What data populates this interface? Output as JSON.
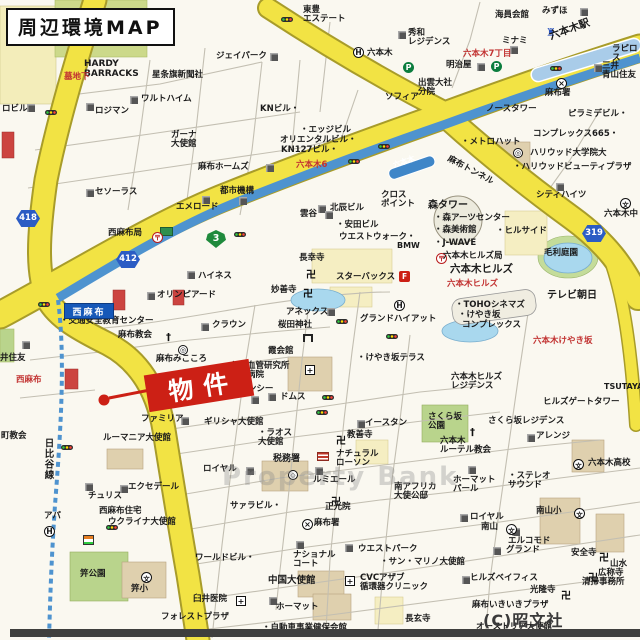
{
  "title": "周辺環境MAP",
  "copyright": "(C)昭文社",
  "watermark": "Property Bank",
  "property_marker": {
    "label": "物件"
  },
  "signs": {
    "nishiazabu": "西麻布"
  },
  "colors": {
    "road_yellow": "#f2e344",
    "subway_blue": "#4e93cf",
    "park_green": "#b9d48c",
    "pond_blue": "#a9d8ee",
    "marker_red": "#cc2015",
    "sign_blue": "#1658b8",
    "shield_blue": "#2b5cc4",
    "shield_green": "#1f8a3c"
  },
  "road_shields": [
    {
      "kind": "metro",
      "num": "3",
      "x": 206,
      "y": 230
    },
    {
      "kind": "pref",
      "num": "412",
      "x": 116,
      "y": 251
    },
    {
      "kind": "pref",
      "num": "418",
      "x": 16,
      "y": 210
    },
    {
      "kind": "pref",
      "num": "319",
      "x": 582,
      "y": 225
    }
  ],
  "labels": [
    {
      "t": "HARDY\nBARRACKS",
      "x": 84,
      "y": 60,
      "fs": 9
    },
    {
      "t": "星条旗新聞社",
      "x": 152,
      "y": 71
    },
    {
      "t": "墓地下",
      "x": 64,
      "y": 73,
      "c": "#c23332"
    },
    {
      "t": "ジェイパーク",
      "x": 216,
      "y": 52
    },
    {
      "t": "東豊\nエステート",
      "x": 303,
      "y": 6
    },
    {
      "t": "秀和\nレジデンス",
      "x": 408,
      "y": 29
    },
    {
      "t": "みずほ",
      "x": 542,
      "y": 7
    },
    {
      "t": "海員会館",
      "x": 495,
      "y": 11
    },
    {
      "t": "ミナミ",
      "x": 502,
      "y": 37
    },
    {
      "t": "明治屋",
      "x": 446,
      "y": 61
    },
    {
      "t": "六本木",
      "x": 367,
      "y": 49
    },
    {
      "t": "出雲大社\n分院",
      "x": 418,
      "y": 79
    },
    {
      "t": "ソフィア",
      "x": 385,
      "y": 93
    },
    {
      "t": "三井\n青山住友",
      "x": 602,
      "y": 62
    },
    {
      "t": "麻布署",
      "x": 545,
      "y": 89
    },
    {
      "t": "ラピロス",
      "x": 612,
      "y": 45
    },
    {
      "t": "六本木7丁目",
      "x": 463,
      "y": 50,
      "c": "#c23332"
    },
    {
      "t": "六本木駅",
      "x": 548,
      "y": 32,
      "fs": 10.5,
      "r": -20,
      "b": 1
    },
    {
      "t": "六本木",
      "x": 392,
      "y": 162,
      "c": "#fff",
      "fs": 7.5,
      "r": -19
    },
    {
      "t": "ワルトハイム",
      "x": 141,
      "y": 95
    },
    {
      "t": "ロジマン",
      "x": 95,
      "y": 107
    },
    {
      "t": "ロビル",
      "x": 2,
      "y": 105
    },
    {
      "t": "KNビル・",
      "x": 260,
      "y": 105
    },
    {
      "t": "ガーナ\n大使館",
      "x": 171,
      "y": 131
    },
    {
      "t": "・エッジビル",
      "x": 300,
      "y": 126
    },
    {
      "t": "オリエンタルビル・",
      "x": 280,
      "y": 136
    },
    {
      "t": "KN127ビル・",
      "x": 281,
      "y": 146
    },
    {
      "t": "六本木6",
      "x": 296,
      "y": 161,
      "c": "#c23332"
    },
    {
      "t": "麻布ホームズ",
      "x": 198,
      "y": 163
    },
    {
      "t": "都市機構",
      "x": 220,
      "y": 187
    },
    {
      "t": "セソーラス",
      "x": 95,
      "y": 188
    },
    {
      "t": "エメロード",
      "x": 176,
      "y": 203
    },
    {
      "t": "ハイネス",
      "x": 198,
      "y": 272
    },
    {
      "t": "西麻布局",
      "x": 108,
      "y": 229
    },
    {
      "t": "オリンピアード",
      "x": 157,
      "y": 291
    },
    {
      "t": "麻布トンネル",
      "x": 450,
      "y": 155,
      "r": 28
    },
    {
      "t": "・メトロハット",
      "x": 461,
      "y": 138
    },
    {
      "t": "ノースタワー",
      "x": 486,
      "y": 105
    },
    {
      "t": "ピラミデビル・",
      "x": 568,
      "y": 110
    },
    {
      "t": "コンプレックス665・",
      "x": 533,
      "y": 130
    },
    {
      "t": "ハリウッド大学院大",
      "x": 530,
      "y": 149
    },
    {
      "t": "・ハリウッドビューティプラザ",
      "x": 513,
      "y": 163
    },
    {
      "t": "シティハイツ",
      "x": 536,
      "y": 191
    },
    {
      "t": "クロス\nポイント",
      "x": 381,
      "y": 191
    },
    {
      "t": "北辰ビル",
      "x": 330,
      "y": 204
    },
    {
      "t": "雲谷",
      "x": 300,
      "y": 210
    },
    {
      "t": "・安田ビル",
      "x": 336,
      "y": 221
    },
    {
      "t": "ウエストウォーク・",
      "x": 339,
      "y": 233
    },
    {
      "t": "BMW",
      "x": 397,
      "y": 242,
      "fs": 8,
      "b": 1
    },
    {
      "t": "長幸寺",
      "x": 299,
      "y": 254
    },
    {
      "t": "妙善寺",
      "x": 271,
      "y": 286
    },
    {
      "t": "スターバックス",
      "x": 336,
      "y": 273
    },
    {
      "t": "森タワー",
      "x": 428,
      "y": 200,
      "fs": 10
    },
    {
      "t": "・森アーツセンター",
      "x": 434,
      "y": 214
    },
    {
      "t": "・森美術館",
      "x": 434,
      "y": 226
    },
    {
      "t": "・ヒルサイド",
      "x": 496,
      "y": 227
    },
    {
      "t": "・J-WAVE",
      "x": 434,
      "y": 239
    },
    {
      "t": "六本木ヒルズ局",
      "x": 443,
      "y": 252
    },
    {
      "t": "六本木ヒルズ",
      "x": 450,
      "y": 264,
      "fs": 10.5
    },
    {
      "t": "六本木ヒルズ",
      "x": 447,
      "y": 280,
      "c": "#c23332"
    },
    {
      "t": "・TOHOシネマズ",
      "x": 455,
      "y": 301
    },
    {
      "t": "・けやき坂",
      "x": 458,
      "y": 311
    },
    {
      "t": "コンプレックス",
      "x": 462,
      "y": 321
    },
    {
      "t": "毛利庭園",
      "x": 544,
      "y": 249
    },
    {
      "t": "テレビ朝日",
      "x": 547,
      "y": 290,
      "fs": 10
    },
    {
      "t": "六本木けやき坂",
      "x": 533,
      "y": 337,
      "c": "#c23332"
    },
    {
      "t": "六本木ヒルズ\nレジデンス",
      "x": 451,
      "y": 373
    },
    {
      "t": "・けやき坂テラス",
      "x": 357,
      "y": 354
    },
    {
      "t": "グランドハイアット",
      "x": 360,
      "y": 315
    },
    {
      "t": "桜田神社",
      "x": 278,
      "y": 321
    },
    {
      "t": "霞会館",
      "x": 268,
      "y": 347
    },
    {
      "t": "心臓血管研究所\n付属病院",
      "x": 230,
      "y": 362
    },
    {
      "t": "ドムス",
      "x": 280,
      "y": 393
    },
    {
      "t": "アネックス",
      "x": 286,
      "y": 308
    },
    {
      "t": "リージェンシー",
      "x": 214,
      "y": 385
    },
    {
      "t": "・交通安全教育センター",
      "x": 60,
      "y": 317
    },
    {
      "t": "麻布教会",
      "x": 118,
      "y": 331
    },
    {
      "t": "クラウン",
      "x": 212,
      "y": 321
    },
    {
      "t": "麻布みこころ",
      "x": 156,
      "y": 355
    },
    {
      "t": "ギリシャ大使館",
      "x": 204,
      "y": 418
    },
    {
      "t": "・ラオス\n大使館",
      "x": 258,
      "y": 429
    },
    {
      "t": "教善寺",
      "x": 347,
      "y": 431
    },
    {
      "t": "ファミリア",
      "x": 141,
      "y": 415
    },
    {
      "t": "ルーマニア大使館",
      "x": 103,
      "y": 434
    },
    {
      "t": "エクセデール",
      "x": 128,
      "y": 483
    },
    {
      "t": "チュリス",
      "x": 88,
      "y": 492
    },
    {
      "t": "西麻布住宅",
      "x": 99,
      "y": 507
    },
    {
      "t": "ウクライナ大使館",
      "x": 108,
      "y": 518
    },
    {
      "t": "アパ",
      "x": 44,
      "y": 512
    },
    {
      "t": "町教会",
      "x": 1,
      "y": 432
    },
    {
      "t": "日比谷線",
      "x": 42,
      "y": 438,
      "v": 1,
      "fs": 9.5,
      "b": 1
    },
    {
      "t": "税務署",
      "x": 273,
      "y": 455,
      "fs": 9
    },
    {
      "t": "ナチュラル\nローソン",
      "x": 336,
      "y": 450
    },
    {
      "t": "イースタン",
      "x": 365,
      "y": 419
    },
    {
      "t": "ルミエール",
      "x": 313,
      "y": 476
    },
    {
      "t": "ロイヤル",
      "x": 203,
      "y": 465
    },
    {
      "t": "サァラビル・",
      "x": 230,
      "y": 502
    },
    {
      "t": "正光院",
      "x": 325,
      "y": 503
    },
    {
      "t": "麻布署",
      "x": 314,
      "y": 519
    },
    {
      "t": "南アフリカ\n大使公邸",
      "x": 394,
      "y": 483
    },
    {
      "t": "さくら坂\n公園",
      "x": 428,
      "y": 413
    },
    {
      "t": "さくら坂レジデンス",
      "x": 488,
      "y": 417
    },
    {
      "t": "アレンジ",
      "x": 536,
      "y": 432
    },
    {
      "t": "六本木\nルーテル教会",
      "x": 440,
      "y": 437
    },
    {
      "t": "ヒルズゲートタワー",
      "x": 543,
      "y": 398
    },
    {
      "t": "TSUTAYA",
      "x": 604,
      "y": 383,
      "fs": 8
    },
    {
      "t": "・ステレオ\nサウンド",
      "x": 508,
      "y": 472
    },
    {
      "t": "ホーマット\nパール",
      "x": 453,
      "y": 476
    },
    {
      "t": "ロイヤル",
      "x": 470,
      "y": 513
    },
    {
      "t": "南山小",
      "x": 536,
      "y": 507
    },
    {
      "t": "南山",
      "x": 481,
      "y": 523
    },
    {
      "t": "六本木高校",
      "x": 588,
      "y": 459
    },
    {
      "t": "六本木中",
      "x": 604,
      "y": 210
    },
    {
      "t": "エルコモド",
      "x": 508,
      "y": 537
    },
    {
      "t": "グランド",
      "x": 506,
      "y": 546
    },
    {
      "t": "・サン・マリノ大使館",
      "x": 380,
      "y": 558
    },
    {
      "t": "ヒルズベイフィス",
      "x": 470,
      "y": 574
    },
    {
      "t": "光隆寺",
      "x": 530,
      "y": 586
    },
    {
      "t": "安全寺",
      "x": 571,
      "y": 549
    },
    {
      "t": "山水",
      "x": 610,
      "y": 560
    },
    {
      "t": "広称寺",
      "x": 598,
      "y": 569
    },
    {
      "t": "清掃事務所",
      "x": 582,
      "y": 578
    },
    {
      "t": "麻布いきいきプラザ",
      "x": 472,
      "y": 601
    },
    {
      "t": "オーストリア大使館",
      "x": 476,
      "y": 623
    },
    {
      "t": "中国大使館",
      "x": 268,
      "y": 576,
      "fs": 9.5
    },
    {
      "t": "CVCアザブ\n循環器クリニック",
      "x": 360,
      "y": 574
    },
    {
      "t": "ウエストパーク",
      "x": 358,
      "y": 545
    },
    {
      "t": "ナショナル\nコート",
      "x": 293,
      "y": 551
    },
    {
      "t": "ワールドビル・",
      "x": 195,
      "y": 554
    },
    {
      "t": "ホーマット",
      "x": 276,
      "y": 603
    },
    {
      "t": "・自動車事業健保会館",
      "x": 262,
      "y": 624
    },
    {
      "t": "長玄寺",
      "x": 405,
      "y": 615
    },
    {
      "t": "臼井医院",
      "x": 193,
      "y": 595
    },
    {
      "t": "笄公園",
      "x": 80,
      "y": 570
    },
    {
      "t": "笄小",
      "x": 131,
      "y": 585
    },
    {
      "t": "フォレストプラザ",
      "x": 161,
      "y": 613
    },
    {
      "t": "井住友",
      "x": 0,
      "y": 354
    },
    {
      "t": "西麻布",
      "x": 16,
      "y": 376,
      "c": "#c23332"
    }
  ],
  "icons": [
    [
      "building",
      270,
      53
    ],
    [
      "building",
      398,
      31
    ],
    [
      "building",
      580,
      8
    ],
    [
      "building",
      510,
      46
    ],
    [
      "building",
      477,
      63
    ],
    [
      "building",
      130,
      96
    ],
    [
      "building",
      86,
      103
    ],
    [
      "building",
      27,
      104
    ],
    [
      "building",
      266,
      164
    ],
    [
      "building",
      239,
      197
    ],
    [
      "building",
      187,
      271
    ],
    [
      "building",
      86,
      189
    ],
    [
      "building",
      202,
      196
    ],
    [
      "building",
      147,
      292
    ],
    [
      "building",
      318,
      205
    ],
    [
      "building",
      325,
      211
    ],
    [
      "building",
      327,
      308
    ],
    [
      "building",
      268,
      393
    ],
    [
      "building",
      251,
      396
    ],
    [
      "building",
      181,
      417
    ],
    [
      "building",
      120,
      485
    ],
    [
      "building",
      85,
      483
    ],
    [
      "building",
      246,
      467
    ],
    [
      "building",
      315,
      467
    ],
    [
      "building",
      357,
      420
    ],
    [
      "building",
      527,
      434
    ],
    [
      "building",
      462,
      576
    ],
    [
      "building",
      493,
      547
    ],
    [
      "building",
      512,
      528
    ],
    [
      "building",
      468,
      466
    ],
    [
      "building",
      345,
      544
    ],
    [
      "building",
      296,
      541
    ],
    [
      "building",
      269,
      597
    ],
    [
      "building",
      556,
      183
    ],
    [
      "building",
      594,
      64
    ],
    [
      "building",
      22,
      341
    ],
    [
      "building",
      201,
      323
    ],
    [
      "building",
      460,
      514
    ],
    [
      "traffic",
      281,
      17
    ],
    [
      "traffic",
      45,
      110
    ],
    [
      "traffic",
      38,
      302
    ],
    [
      "traffic",
      61,
      445
    ],
    [
      "traffic",
      336,
      319
    ],
    [
      "traffic",
      386,
      334
    ],
    [
      "traffic",
      322,
      395
    ],
    [
      "traffic",
      316,
      410
    ],
    [
      "traffic",
      378,
      144
    ],
    [
      "traffic",
      348,
      159
    ],
    [
      "traffic",
      234,
      232
    ],
    [
      "traffic",
      106,
      525
    ],
    [
      "traffic",
      550,
      66
    ],
    [
      "parking",
      491,
      61
    ],
    [
      "parking",
      403,
      62
    ],
    [
      "hotel",
      353,
      47
    ],
    [
      "hotel",
      394,
      300
    ],
    [
      "hotel",
      44,
      526
    ],
    [
      "police",
      556,
      78
    ],
    [
      "police",
      302,
      519
    ],
    [
      "school",
      574,
      508
    ],
    [
      "school",
      506,
      524
    ],
    [
      "school",
      573,
      459
    ],
    [
      "school",
      620,
      198
    ],
    [
      "school",
      141,
      572
    ],
    [
      "hospital",
      305,
      365
    ],
    [
      "hospital",
      345,
      576
    ],
    [
      "hospital",
      236,
      596
    ],
    [
      "temple",
      306,
      266
    ],
    [
      "temple",
      303,
      285
    ],
    [
      "temple",
      336,
      432
    ],
    [
      "temple",
      331,
      493
    ],
    [
      "temple",
      561,
      587
    ],
    [
      "temple",
      599,
      549
    ],
    [
      "temple",
      588,
      569
    ],
    [
      "church",
      166,
      332
    ],
    [
      "church",
      470,
      427
    ],
    [
      "torii",
      303,
      334
    ],
    [
      "castle",
      546,
      26
    ],
    [
      "starF",
      399,
      271
    ],
    [
      "lawson",
      317,
      452
    ],
    [
      "greensign",
      160,
      227
    ],
    [
      "store7",
      83,
      535
    ],
    [
      "emblem",
      178,
      345
    ],
    [
      "emblem",
      513,
      148
    ],
    [
      "post",
      436,
      253
    ],
    [
      "post",
      152,
      232
    ],
    [
      "tax",
      288,
      470
    ]
  ]
}
